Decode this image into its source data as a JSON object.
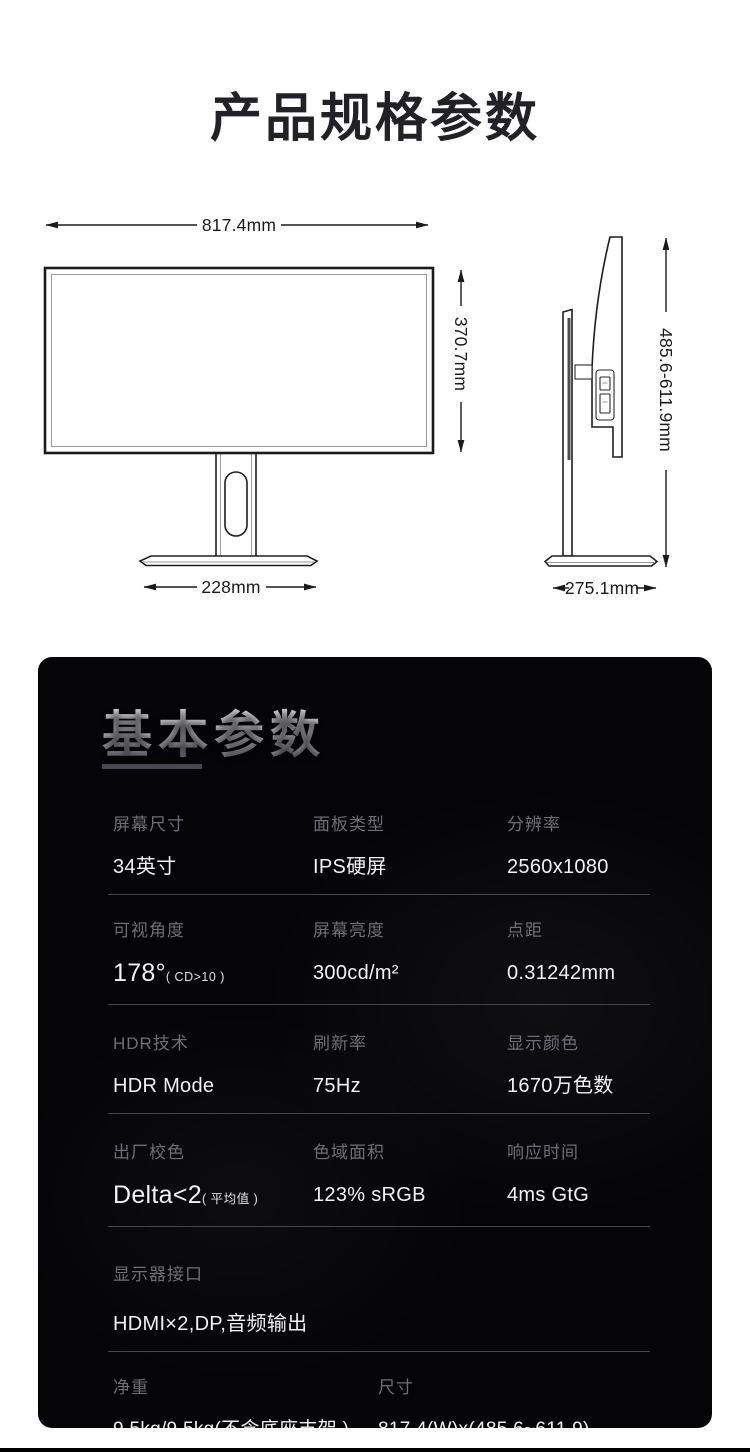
{
  "page": {
    "title": "产品规格参数"
  },
  "diagrams": {
    "front": {
      "width_label": "817.4mm",
      "height_label": "370.7mm",
      "stand_base_width_label": "228mm"
    },
    "side": {
      "height_range_label": "485.6-611.9mm",
      "depth_label": "275.1mm"
    }
  },
  "specs_panel": {
    "heading": "基本参数",
    "colors": {
      "panel_bg": "#050507",
      "label": "#6e6e76",
      "value": "#f2f2f4",
      "divider": "#45454c",
      "heading_underline": "#46464e"
    },
    "rows": [
      [
        {
          "label": "屏幕尺寸",
          "value": "34英寸"
        },
        {
          "label": "面板类型",
          "value": "IPS硬屏"
        },
        {
          "label": "分辨率",
          "value": "2560x1080"
        }
      ],
      [
        {
          "label": "可视角度",
          "value": "178°",
          "note": "( CD>10 )"
        },
        {
          "label": "屏幕亮度",
          "value": "300cd/m²"
        },
        {
          "label": "点距",
          "value": "0.31242mm"
        }
      ],
      [
        {
          "label": "HDR技术",
          "value": "HDR Mode"
        },
        {
          "label": "刷新率",
          "value": "75Hz"
        },
        {
          "label": "显示颜色",
          "value": "1670万色数"
        }
      ],
      [
        {
          "label": "出厂校色",
          "value": "Delta<2",
          "note": "( 平均值 )"
        },
        {
          "label": "色域面积",
          "value": "123% sRGB"
        },
        {
          "label": "响应时间",
          "value": "4ms GtG"
        }
      ],
      [
        {
          "label": "显示器接口",
          "value": "HDMI×2,DP,音频输出"
        }
      ],
      [
        {
          "label": "净重",
          "value": "9.5kg/9.5kg(不含底座支架 )"
        },
        {
          "label": "尺寸",
          "value": "817.4(W)x(485.6~611.9)(H)x275.1(D)mm"
        }
      ]
    ]
  }
}
